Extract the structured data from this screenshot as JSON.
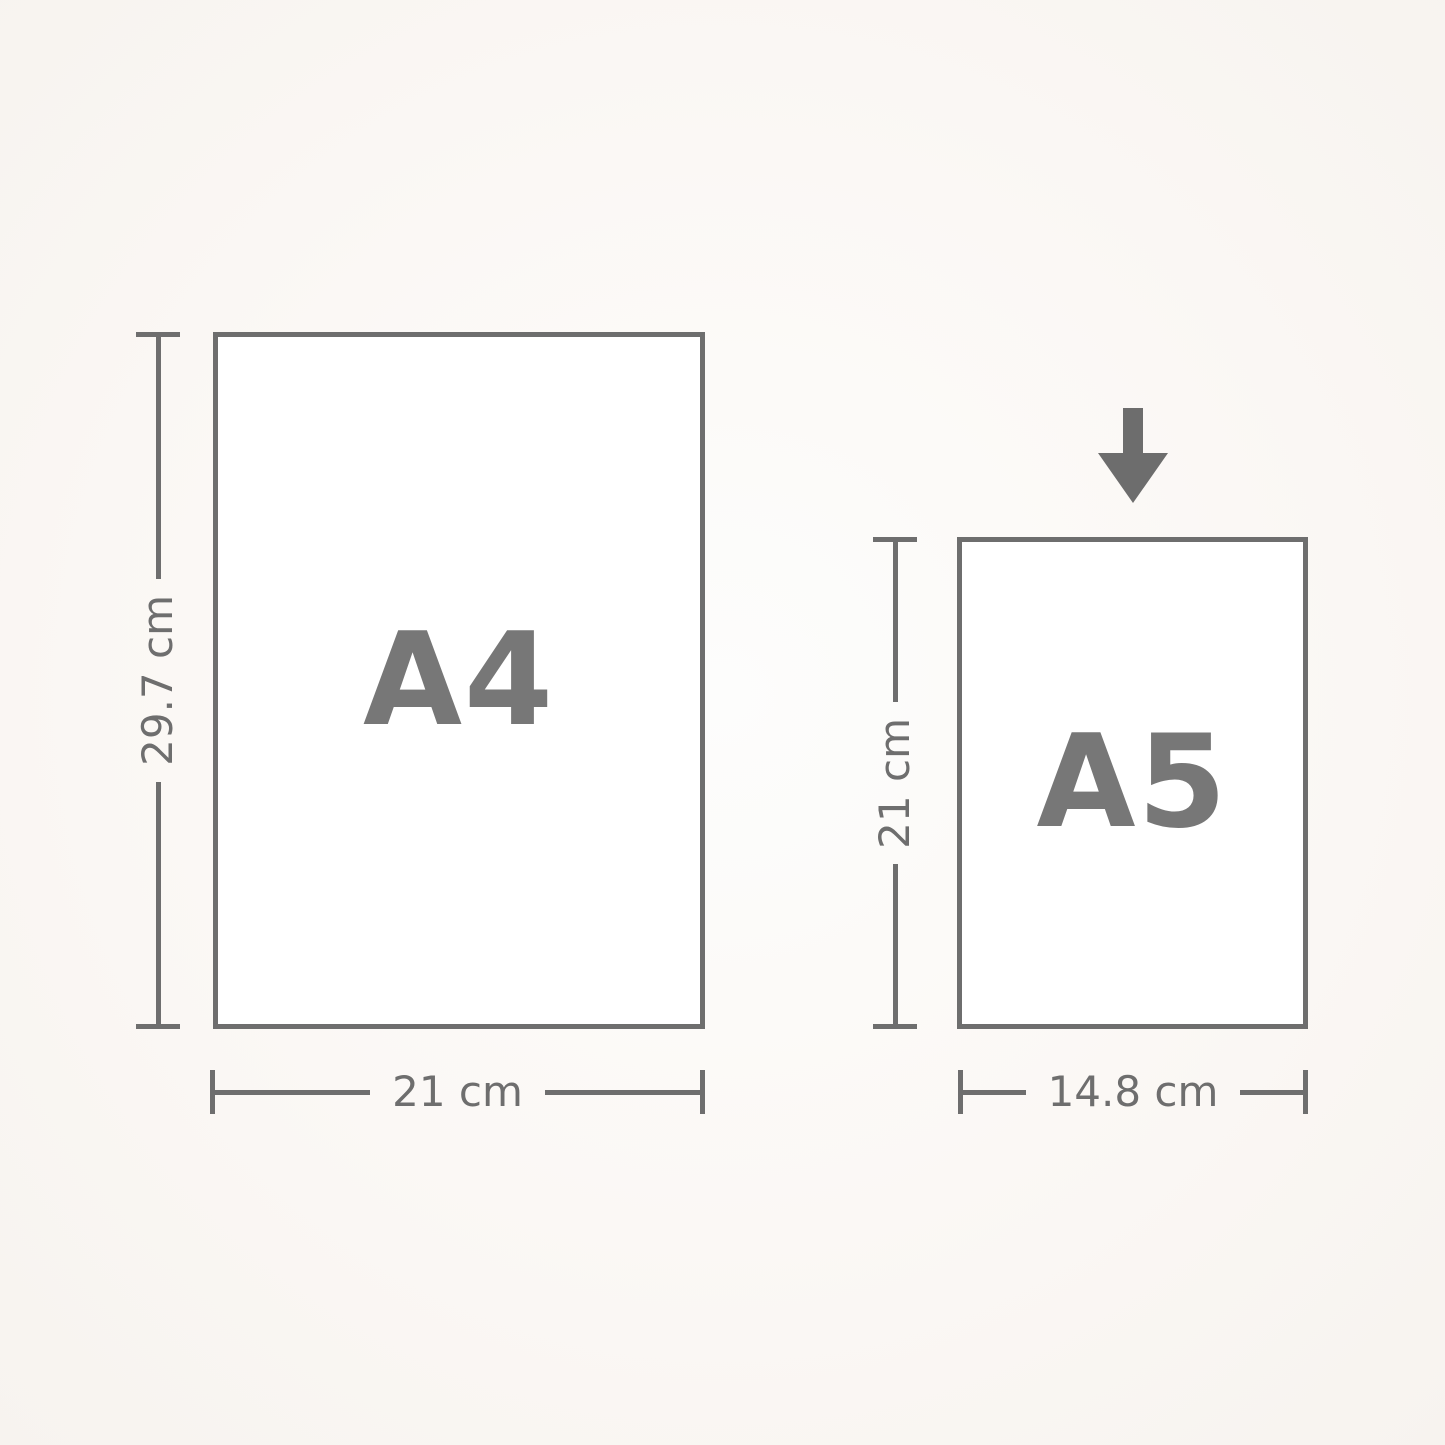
{
  "page": {
    "background_center": "#fdfdfc",
    "background_edge": "#f7f3ef",
    "line_color": "#6e6e6e",
    "label_color": "#777777"
  },
  "papers": [
    {
      "id": "a4",
      "label": "A4",
      "height_label": "29.7 cm",
      "width_label": "21 cm"
    },
    {
      "id": "a5",
      "label": "A5",
      "height_label": "21 cm",
      "width_label": "14.8 cm"
    }
  ],
  "icons": {
    "arrow": "down-arrow"
  }
}
